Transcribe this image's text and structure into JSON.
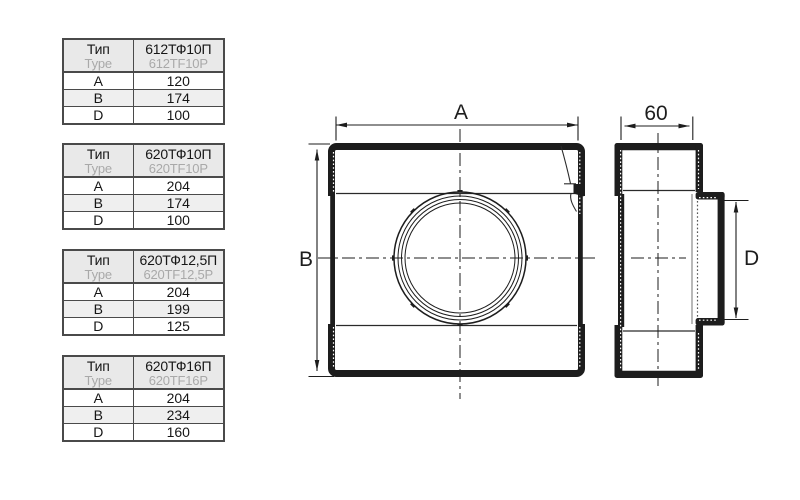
{
  "drawing": {
    "front_view": {
      "width_label": "A",
      "height_label": "B"
    },
    "side_view": {
      "depth_label": "60",
      "diameter_label": "D"
    }
  },
  "tables": [
    {
      "header": {
        "ru": "Тип",
        "en": "Type"
      },
      "model": {
        "ru": "612ТФ10П",
        "en": "612TF10P"
      },
      "rows": [
        {
          "param": "A",
          "value": "120"
        },
        {
          "param": "B",
          "value": "174"
        },
        {
          "param": "D",
          "value": "100"
        }
      ]
    },
    {
      "header": {
        "ru": "Тип",
        "en": "Type"
      },
      "model": {
        "ru": "620ТФ10П",
        "en": "620TF10P"
      },
      "rows": [
        {
          "param": "A",
          "value": "204"
        },
        {
          "param": "B",
          "value": "174"
        },
        {
          "param": "D",
          "value": "100"
        }
      ]
    },
    {
      "header": {
        "ru": "Тип",
        "en": "Type"
      },
      "model": {
        "ru": "620ТФ12,5П",
        "en": "620TF12,5P"
      },
      "rows": [
        {
          "param": "A",
          "value": "204"
        },
        {
          "param": "B",
          "value": "199"
        },
        {
          "param": "D",
          "value": "125"
        }
      ]
    },
    {
      "header": {
        "ru": "Тип",
        "en": "Type"
      },
      "model": {
        "ru": "620ТФ16П",
        "en": "620TF16P"
      },
      "rows": [
        {
          "param": "A",
          "value": "204"
        },
        {
          "param": "B",
          "value": "234"
        },
        {
          "param": "D",
          "value": "160"
        }
      ]
    }
  ]
}
